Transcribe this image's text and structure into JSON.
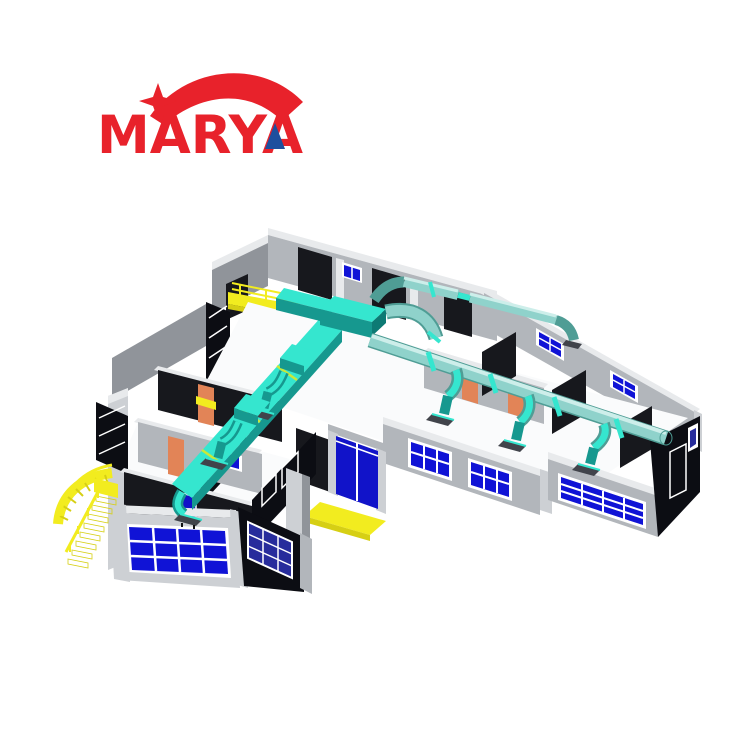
{
  "page": {
    "background": "#ffffff"
  },
  "logo": {
    "text": "MARYA",
    "color": "#e8222b",
    "accent_color": "#1e4f9e",
    "marks": [
      "red-swoosh-arc",
      "four-point-star",
      "blue-triangle-in-final-A"
    ]
  },
  "scene": {
    "description": "3D isometric CAD rendering of a modular pharmaceutical cleanroom facility: grey wall panels, dark interior partitions, blue glazed windows and doors, turquoise rectangular and round HVAC supply ducts with branch drops and ceiling diffusers, yellow access staircase, walkway and entrance ramp",
    "colors": {
      "background": "#ffffff",
      "wall_top": "#e8eaec",
      "wall_light": "#cdd0d4",
      "wall_mid": "#b2b6bb",
      "wall_dark": "#90949a",
      "interior_dark": "#17181d",
      "interior_darker": "#0c0d13",
      "floor_white": "#fafbfc",
      "window_blue": "#1013d6",
      "window_navy": "#272c9c",
      "frame_white": "#ffffff",
      "duct_top": "#35e6cf",
      "duct_side": "#16988f",
      "duct_deep": "#0d7a74",
      "pipe_body": "#8fd2cb",
      "pipe_light": "#cdeeea",
      "pipe_shade": "#4f9d95",
      "flange_green": "#cbe838",
      "stair_yellow": "#f2ec1f",
      "stair_shade": "#d6cf14",
      "door_orange": "#e28457",
      "entrance_blue": "#1113c9",
      "diffuser_gray": "#41444b",
      "logo_red": "#e8222b",
      "logo_blue": "#1e4f9e"
    },
    "components": [
      "back-corridor-walls",
      "right-wing-rooms",
      "left-wing-rooms",
      "front-glazed-room",
      "window-grids",
      "main-entrance-double-door",
      "yellow-access-staircase",
      "yellow-walkway-platform",
      "yellow-entrance-ramp",
      "hvac-rectangular-duct",
      "hvac-round-supply-pipe",
      "duct-branch-drops-with-diffusers",
      "interior-partition-walls",
      "orange-cleanroom-doors"
    ]
  }
}
